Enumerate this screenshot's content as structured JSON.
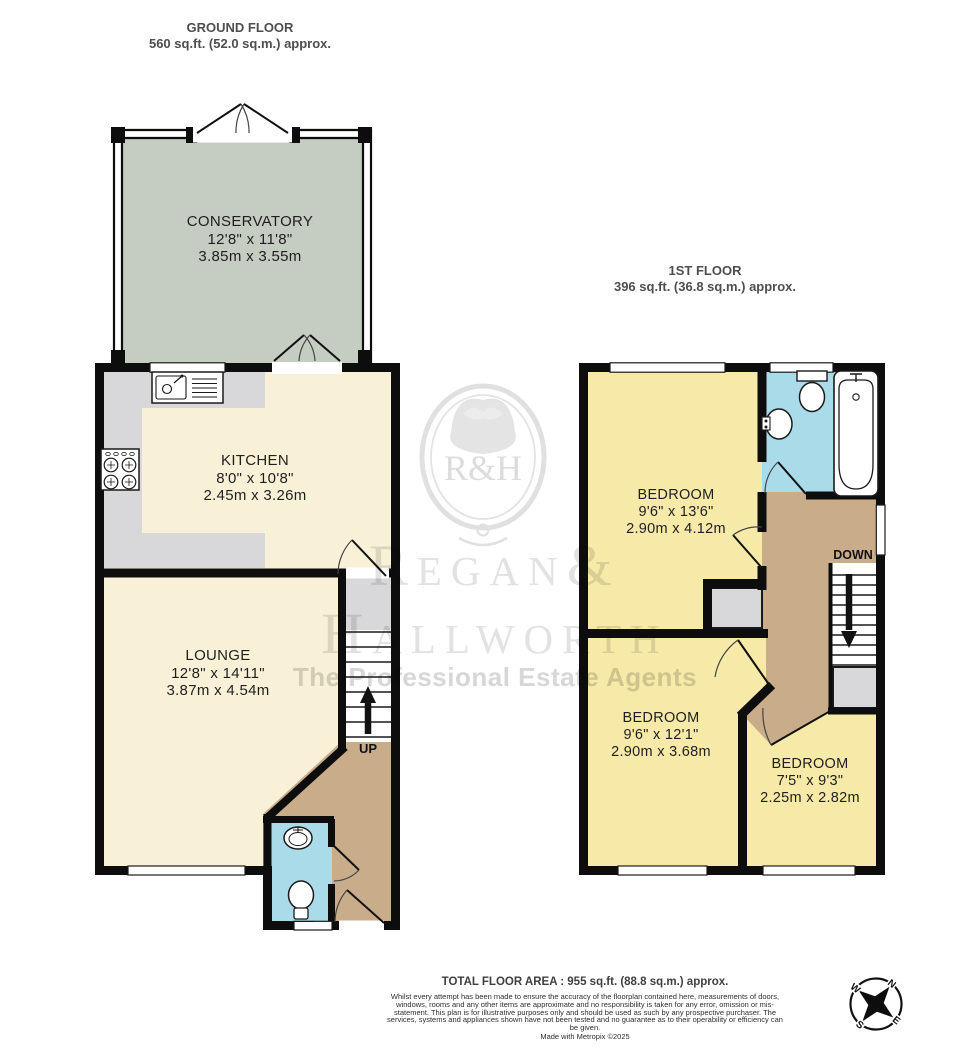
{
  "ground_floor": {
    "title": "GROUND FLOOR",
    "area": "560 sq.ft. (52.0 sq.m.) approx.",
    "conservatory": {
      "name": "CONSERVATORY",
      "imperial": "12'8\" x 11'8\"",
      "metric": "3.85m x 3.55m"
    },
    "kitchen": {
      "name": "KITCHEN",
      "imperial": "8'0\" x 10'8\"",
      "metric": "2.45m x 3.26m"
    },
    "lounge": {
      "name": "LOUNGE",
      "imperial": "12'8\" x 14'11\"",
      "metric": "3.87m x 4.54m"
    },
    "stairs_label": "UP"
  },
  "first_floor": {
    "title": "1ST FLOOR",
    "area": "396 sq.ft. (36.8 sq.m.) approx.",
    "bedroom1": {
      "name": "BEDROOM",
      "imperial": "9'6\" x 13'6\"",
      "metric": "2.90m x 4.12m"
    },
    "bedroom2": {
      "name": "BEDROOM",
      "imperial": "9'6\" x 12'1\"",
      "metric": "2.90m x 3.68m"
    },
    "bedroom3": {
      "name": "BEDROOM",
      "imperial": "7'5\" x 9'3\"",
      "metric": "2.25m x 2.82m"
    },
    "stairs_label": "DOWN"
  },
  "watermark": {
    "crest_text": "R&H",
    "name_line1": "Regan&",
    "name_line2": "Hallworth",
    "tagline": "The Professional Estate Agents"
  },
  "footer": {
    "total": "TOTAL FLOOR AREA : 955 sq.ft. (88.8 sq.m.) approx.",
    "disclaimer": "Whilst every attempt has been made to ensure the accuracy of the floorplan contained here, measurements of doors, windows, rooms and any other items are approximate and no responsibility is taken for any error, omission or mis-statement. This plan is for illustrative purposes only and should be used as such by any prospective purchaser. The services, systems and appliances shown have not been tested and no guarantee as to their operability or efficiency can be given.",
    "credit": "Made with Metropix ©2025"
  },
  "compass": {
    "north": "N",
    "south": "S",
    "east": "E",
    "west": "W"
  },
  "colors": {
    "room_cream": "#f9f1d7",
    "room_yellow": "#f7e9a8",
    "room_cyan": "#aadbe9",
    "room_tan": "#c9ad8b",
    "room_sage": "#c5ccc1",
    "counter_gray": "#d8d8da",
    "wall": "#0d0d0d",
    "watermark_gray": "#e2e2e2"
  }
}
